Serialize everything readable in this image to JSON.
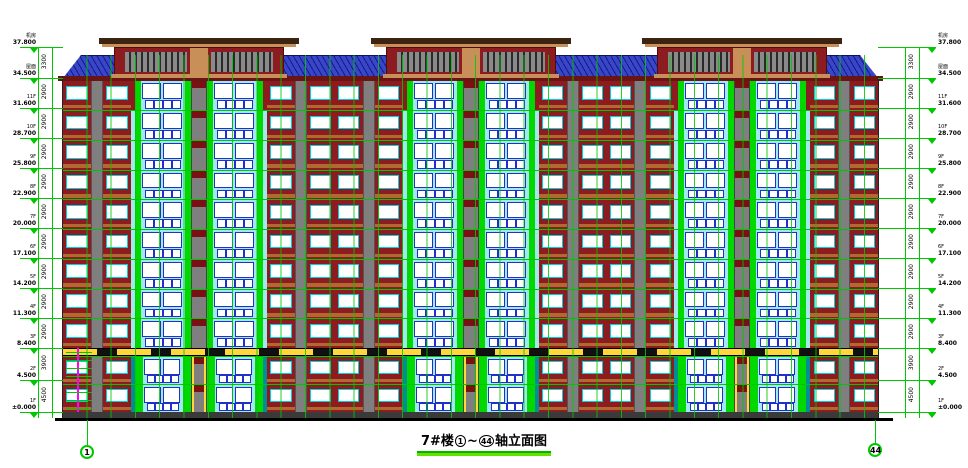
{
  "title": {
    "prefix": "7#楼",
    "axis_start": "1",
    "tilde": "~",
    "axis_end": "44",
    "suffix": "轴立面图"
  },
  "axis_bubbles": {
    "left": "1",
    "right": "44"
  },
  "levels": [
    {
      "elev": "37.800",
      "tag": "机房"
    },
    {
      "elev": "34.500",
      "tag": "屋面"
    },
    {
      "elev": "31.600",
      "tag": "11F"
    },
    {
      "elev": "28.700",
      "tag": "10F"
    },
    {
      "elev": "25.800",
      "tag": "9F"
    },
    {
      "elev": "22.900",
      "tag": "8F"
    },
    {
      "elev": "20.000",
      "tag": "7F"
    },
    {
      "elev": "17.100",
      "tag": "6F"
    },
    {
      "elev": "14.200",
      "tag": "5F"
    },
    {
      "elev": "11.300",
      "tag": "4F"
    },
    {
      "elev": "8.400",
      "tag": "3F"
    },
    {
      "elev": "4.500",
      "tag": "2F"
    },
    {
      "elev": "±0.000",
      "tag": "1F"
    }
  ],
  "floor_dims": [
    "3300",
    "2900",
    "2900",
    "2900",
    "2900",
    "2900",
    "2900",
    "2900",
    "2900",
    "2900",
    "3900",
    "4500"
  ],
  "palette": {
    "cad_green": "#00c800",
    "wall_cyan": "#9fe9ef",
    "wall_red": "#8c1c1f",
    "shaft_red": "#7a0f14",
    "eave_red": "#6b1414",
    "accent_green": "#00d800",
    "frame_blue": "#2030c8",
    "frame_cyan": "#00d0e0",
    "pilaster_gray": "#7f7f7f",
    "sill_brown": "#b06a30",
    "slab_tan": "#c89058",
    "roof_blue": "#3a46c8",
    "podium_teal": "#008e96",
    "frieze_yellow": "#ffd738",
    "magenta": "#ff00ff"
  }
}
